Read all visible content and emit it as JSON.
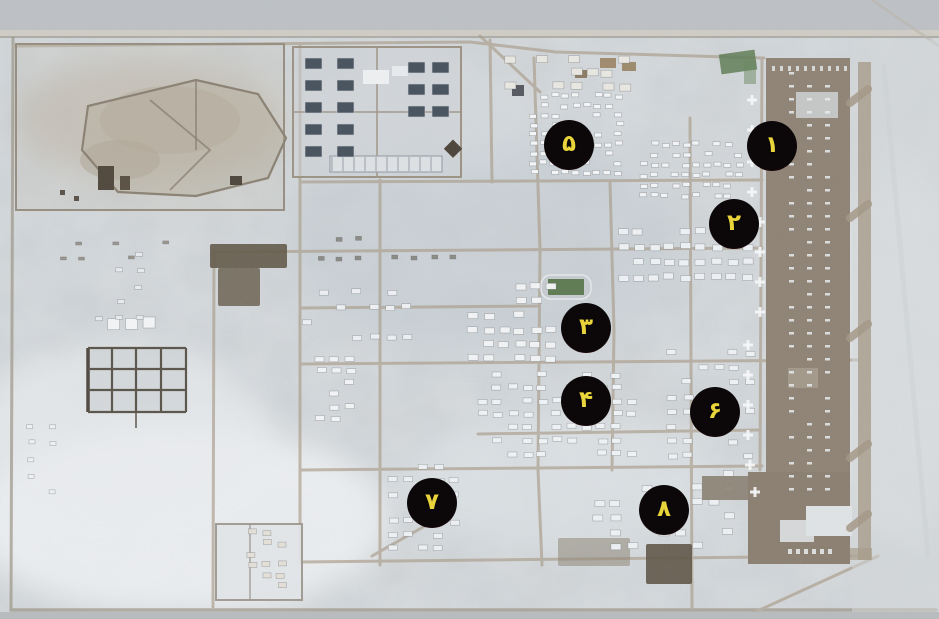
{
  "markers": [
    {
      "id": "1",
      "numeral": "۱",
      "latin": 1,
      "x": 772,
      "y": 146
    },
    {
      "id": "2",
      "numeral": "۲",
      "latin": 2,
      "x": 734,
      "y": 224
    },
    {
      "id": "3",
      "numeral": "۳",
      "latin": 3,
      "x": 586,
      "y": 328
    },
    {
      "id": "4",
      "numeral": "۴",
      "latin": 4,
      "x": 586,
      "y": 401
    },
    {
      "id": "5",
      "numeral": "۵",
      "latin": 5,
      "x": 569,
      "y": 145
    },
    {
      "id": "6",
      "numeral": "۶",
      "latin": 6,
      "x": 715,
      "y": 412
    },
    {
      "id": "7",
      "numeral": "۷",
      "latin": 7,
      "x": 432,
      "y": 503
    },
    {
      "id": "8",
      "numeral": "۸",
      "latin": 8,
      "x": 664,
      "y": 510
    }
  ],
  "marker_style": {
    "fill": "#0c0809",
    "ring": "#8e0f13",
    "highlight": "#b3151b",
    "text": "#e9d43b"
  },
  "palette": {
    "desert_base": "#ccd2d7",
    "bright_ground": "#e9edf0",
    "top_band": "#bcc0c4",
    "road": "#ab9f8e",
    "apron": "#8e8375",
    "taxiway": "#a89c8a",
    "dark_ground": "#625948",
    "dark_building": "#47525e",
    "vegetation": "#5e7b53"
  }
}
